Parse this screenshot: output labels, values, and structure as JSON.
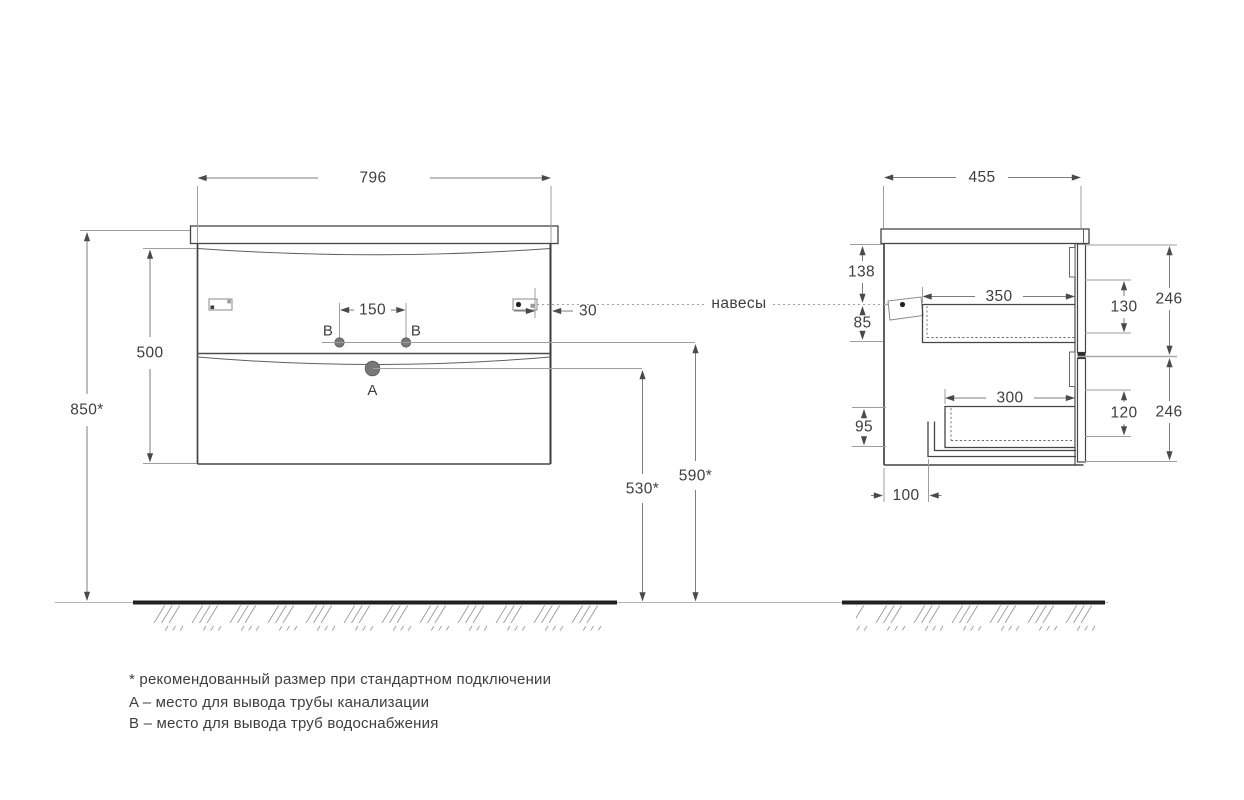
{
  "drawing": {
    "front_view": {
      "width": "796",
      "body_height": "500",
      "mount_height": "850*",
      "outlet_b_spacing": "150",
      "hanger_edge_offset": "30",
      "outlet_a_height": "530*",
      "outlet_b_height": "590*",
      "hangers_label": "навесы",
      "outlet_a_label": "A",
      "outlet_b_label_left": "B",
      "outlet_b_label_right": "B"
    },
    "side_view": {
      "depth": "455",
      "hanger_top_offset": "138",
      "hanger_drawer_gap": "85",
      "top_drawer_depth": "350",
      "top_drawer_height": "130",
      "top_front_height": "246",
      "bottom_drawer_depth": "300",
      "bottom_drawer_height": "120",
      "bottom_front_height": "246",
      "bottom_offset": "95",
      "pipe_offset": "100"
    }
  },
  "legend": {
    "asterisk_note": "* рекомендованный размер при стандартном подключении",
    "a_note": "A – место для вывода трубы канализации",
    "b_note": "B – место для вывода труб водоснабжения"
  }
}
